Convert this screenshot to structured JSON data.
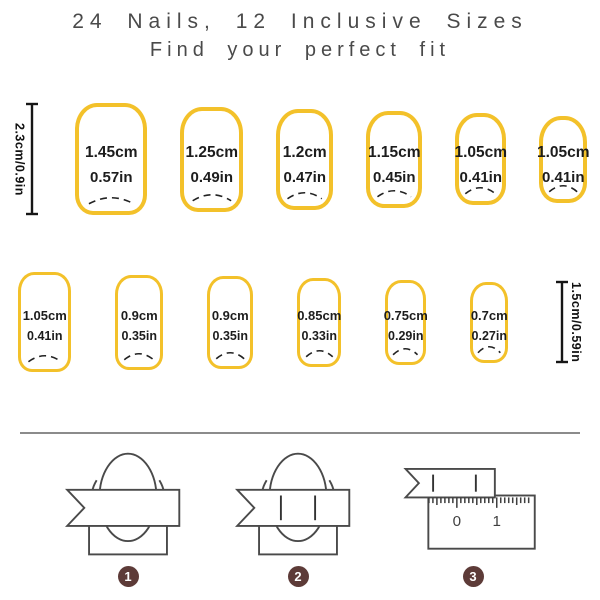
{
  "title": {
    "line1": "24 Nails, 12 Inclusive Sizes",
    "line2": "Find your perfect fit"
  },
  "colors": {
    "nail_outline": "#F3C12A",
    "badge_background": "#5d3b38",
    "title_text": "#4a4a4a",
    "measurement_text": "#1d1d1d"
  },
  "row1": {
    "height_label": "2.3cm/0.9in",
    "nails": [
      {
        "cm": "1.45cm",
        "in": "0.57in"
      },
      {
        "cm": "1.25cm",
        "in": "0.49in"
      },
      {
        "cm": "1.2cm",
        "in": "0.47in"
      },
      {
        "cm": "1.15cm",
        "in": "0.45in"
      },
      {
        "cm": "1.05cm",
        "in": "0.41in"
      },
      {
        "cm": "1.05cm",
        "in": "0.41in"
      }
    ]
  },
  "row2": {
    "height_label": "1.5cm/0.59in",
    "nails": [
      {
        "cm": "1.05cm",
        "in": "0.41in"
      },
      {
        "cm": "0.9cm",
        "in": "0.35in"
      },
      {
        "cm": "0.9cm",
        "in": "0.35in"
      },
      {
        "cm": "0.85cm",
        "in": "0.33in"
      },
      {
        "cm": "0.75cm",
        "in": "0.29in"
      },
      {
        "cm": "0.7cm",
        "in": "0.27in"
      }
    ]
  },
  "steps": [
    {
      "number": "1"
    },
    {
      "number": "2"
    },
    {
      "number": "3"
    }
  ],
  "ruler": {
    "labels": [
      "0",
      "1"
    ]
  }
}
